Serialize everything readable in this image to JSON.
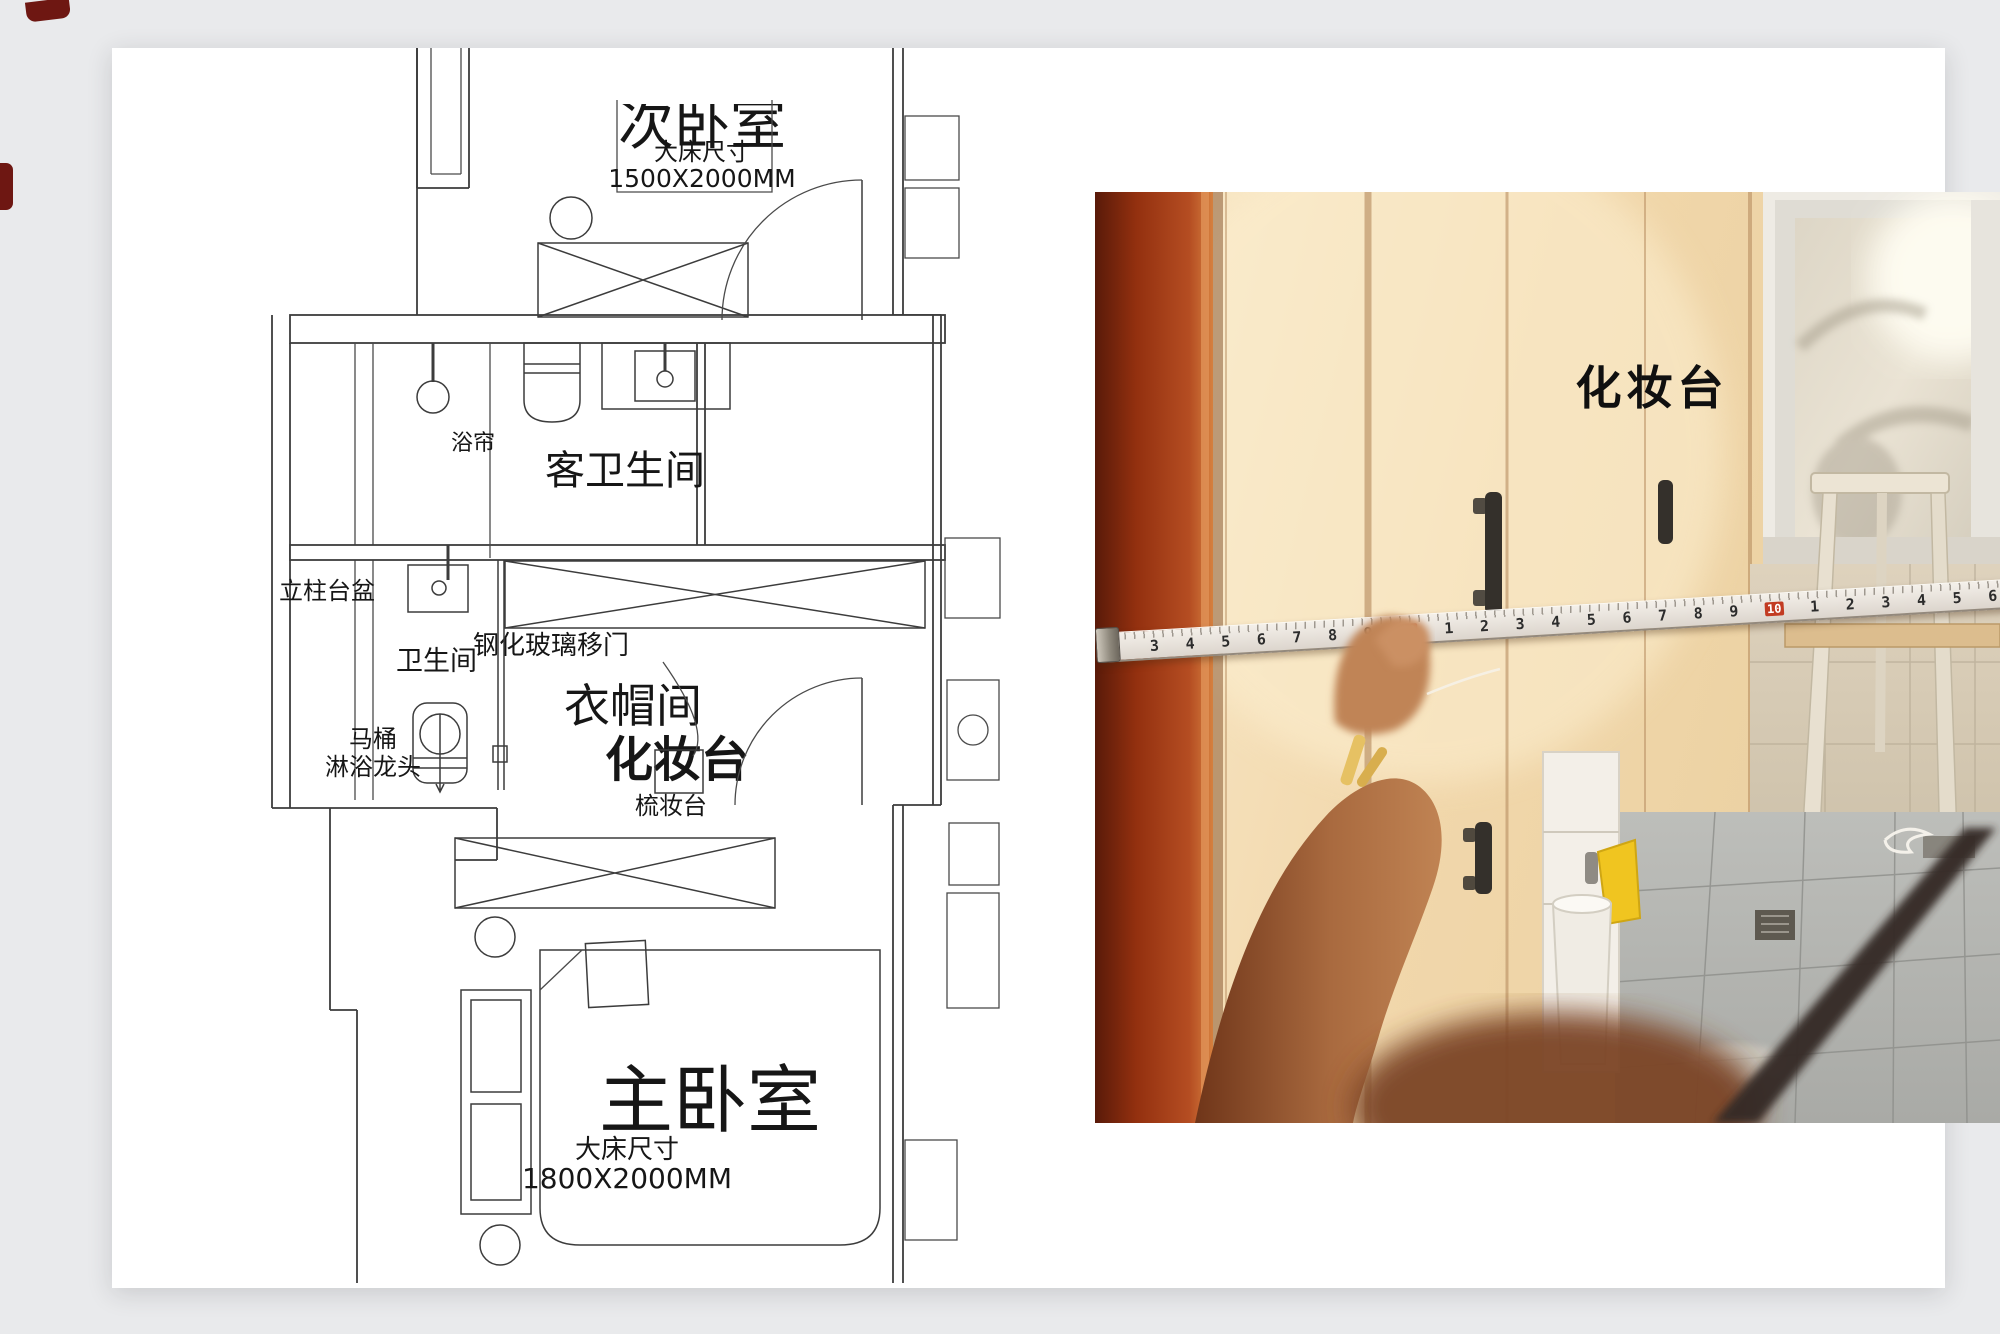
{
  "colors": {
    "page_bg": "#e9eaec",
    "plan_line": "#3c3c3c",
    "door_frame_red": "#a03b18",
    "cabinet_wood": "#f0d7b2",
    "tape_red": "#c23b22",
    "label_ink": "#111111"
  },
  "floor_plan": {
    "rooms": {
      "secondary_bedroom": {
        "name": "次卧室",
        "size_caption": "大床尺寸",
        "size_value": "1500X2000MM"
      },
      "guest_bathroom": {
        "name": "客卫生间"
      },
      "bathroom": {
        "name": "卫生间"
      },
      "cloakroom": {
        "name": "衣帽间"
      },
      "master_bedroom": {
        "name": "主卧室",
        "size_caption": "大床尺寸",
        "size_value": "1800X2000MM"
      }
    },
    "labels": {
      "shower_curtain": "浴帘",
      "pedestal_basin": "立柱台盆",
      "tempered_glass_sliding_door": "钢化玻璃移门",
      "toilet": "马桶",
      "shower_faucet": "淋浴龙头",
      "dressing_table": "化妆台",
      "vanity_table": "梳妆台"
    }
  },
  "photo": {
    "caption": "化妆台",
    "tape_numbers": [
      "3",
      "4",
      "5",
      "6",
      "7",
      "8",
      "9",
      "10",
      "1",
      "2",
      "3",
      "4",
      "5",
      "6",
      "7",
      "8",
      "9",
      "10",
      "1",
      "2",
      "3",
      "4",
      "5",
      "6"
    ]
  }
}
